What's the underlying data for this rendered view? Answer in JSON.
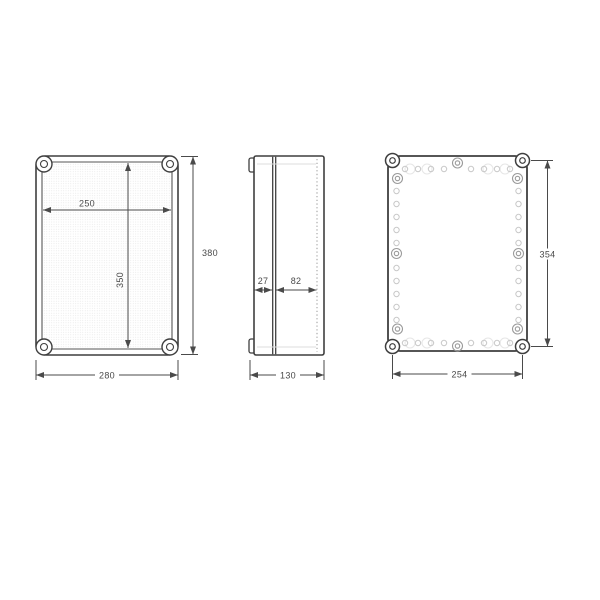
{
  "drawing": {
    "front_view": {
      "inner_width": "250",
      "inner_height": "350",
      "overall_width": "280",
      "overall_height": "380"
    },
    "side_view": {
      "cover_depth": "27",
      "base_depth": "82",
      "overall_depth": "130"
    },
    "rear_view": {
      "mounting_width": "254",
      "mounting_height": "354"
    },
    "colors": {
      "outline": "#3f3f3f",
      "dimension": "#4a4a4a",
      "boss_ring": "#9b9b9b",
      "mounting_hole": "#c8c8c8",
      "faint_circle": "#e6e6e6",
      "texture_dot": "#dfdfdf",
      "hidden_line": "#999999",
      "background": "#ffffff"
    }
  }
}
